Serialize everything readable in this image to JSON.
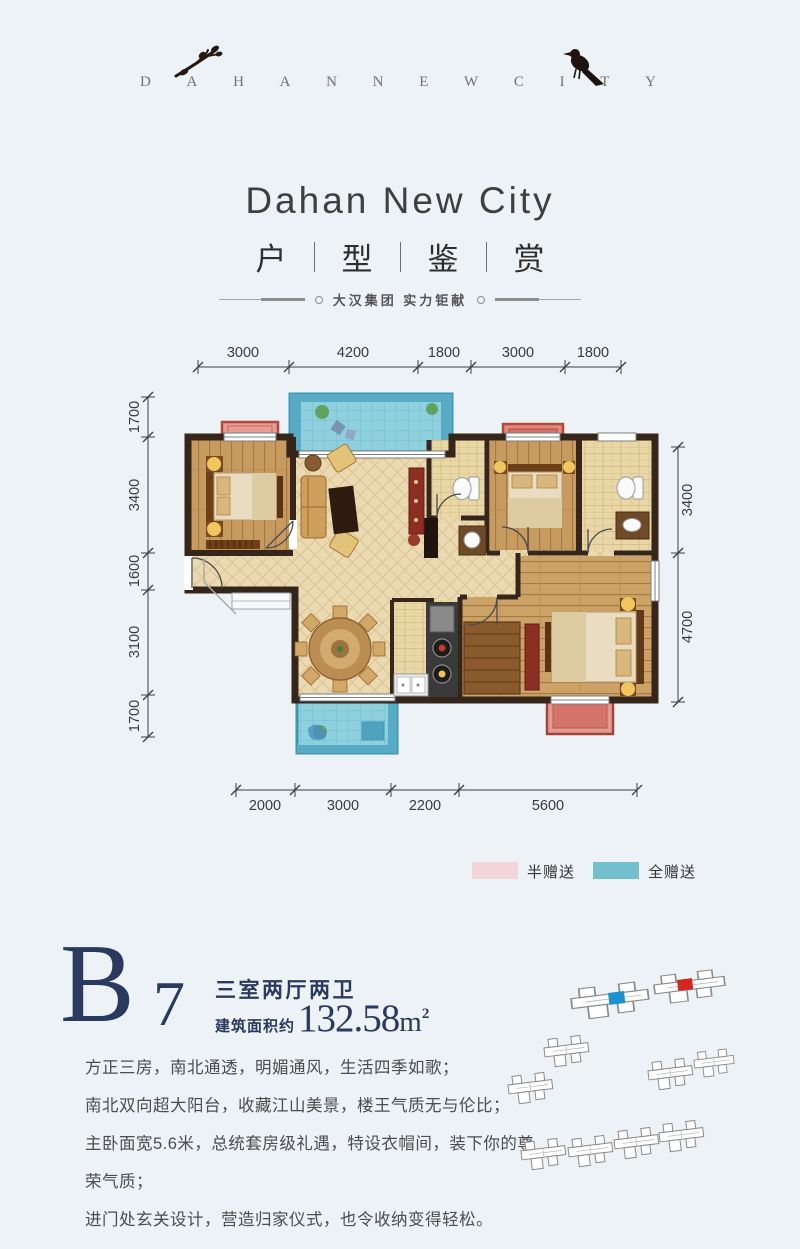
{
  "header": {
    "brand": "DAHANNEWCITY",
    "title": "Dahan New City",
    "subtitle_chars": [
      "户",
      "型",
      "鉴",
      "赏"
    ],
    "tagline": "大汉集团 实力钜献"
  },
  "floor_plan": {
    "dimensions": {
      "top": [
        "3000",
        "4200",
        "1800",
        "3000",
        "1800"
      ],
      "bottom": [
        "2000",
        "3000",
        "2200",
        "5600"
      ],
      "left": [
        "1700",
        "3400",
        "1600",
        "3100",
        "1700"
      ],
      "right": [
        "3400",
        "4700"
      ]
    },
    "legend": [
      {
        "label": "半赠送",
        "color": "#f2d5d6"
      },
      {
        "label": "全赠送",
        "color": "#72bfcd"
      }
    ]
  },
  "unit": {
    "code_letter": "B",
    "code_number": "7",
    "layout": "三室两厅两卫",
    "area_prefix": "建筑面积约",
    "area_value": "132.58",
    "area_unit_base": "m",
    "area_unit_sup": "2"
  },
  "description": {
    "lines": [
      "方正三房，南北通透，明媚通风，生活四季如歌；",
      "南北双向超大阳台，收藏江山美景，楼王气质无与伦比；",
      "主卧面宽5.6米，总统套房级礼遇，特设衣帽间，装下你的尊荣气质；",
      "进门处玄关设计，营造归家仪式，也令收纳变得轻松。"
    ]
  },
  "site_plan": {
    "buildings": [
      {
        "x": 80,
        "y": 38,
        "r": -7,
        "sx": 1.75,
        "sy": 1.1
      },
      {
        "x": 163,
        "y": 25,
        "r": -7,
        "sx": 1.6,
        "sy": 1.0
      },
      {
        "x": 53,
        "y": 88,
        "r": -7,
        "sx": 1.0,
        "sy": 1.0
      },
      {
        "x": 17,
        "y": 125,
        "r": -7,
        "sx": 1.0,
        "sy": 1.0
      },
      {
        "x": 157,
        "y": 111,
        "r": -7,
        "sx": 1.0,
        "sy": 1.0
      },
      {
        "x": 203,
        "y": 101,
        "r": -7,
        "sx": 0.9,
        "sy": 0.9
      },
      {
        "x": 30,
        "y": 191,
        "r": -7,
        "sx": 1.0,
        "sy": 1.0
      },
      {
        "x": 77,
        "y": 188,
        "r": -7,
        "sx": 1.0,
        "sy": 1.0
      },
      {
        "x": 123,
        "y": 180,
        "r": -7,
        "sx": 1.0,
        "sy": 1.0
      },
      {
        "x": 168,
        "y": 173,
        "r": -7,
        "sx": 1.0,
        "sy": 1.0
      }
    ],
    "highlights": [
      {
        "x": 118,
        "y": 41,
        "w": 16,
        "h": 12,
        "r": -7,
        "color": "#1e90d2"
      },
      {
        "x": 187,
        "y": 28,
        "w": 15,
        "h": 11,
        "r": -7,
        "color": "#d62420"
      }
    ]
  },
  "colors": {
    "accent_navy": "#2a3a5f",
    "gift_half_pink": "#f2d5d6",
    "gift_full_teal": "#72bfcd",
    "balcony_teal_border": "#3e97b6",
    "bay_red_border": "#b04a3e",
    "wall_dark": "#36251a",
    "page_bg": "#edf2f7"
  }
}
